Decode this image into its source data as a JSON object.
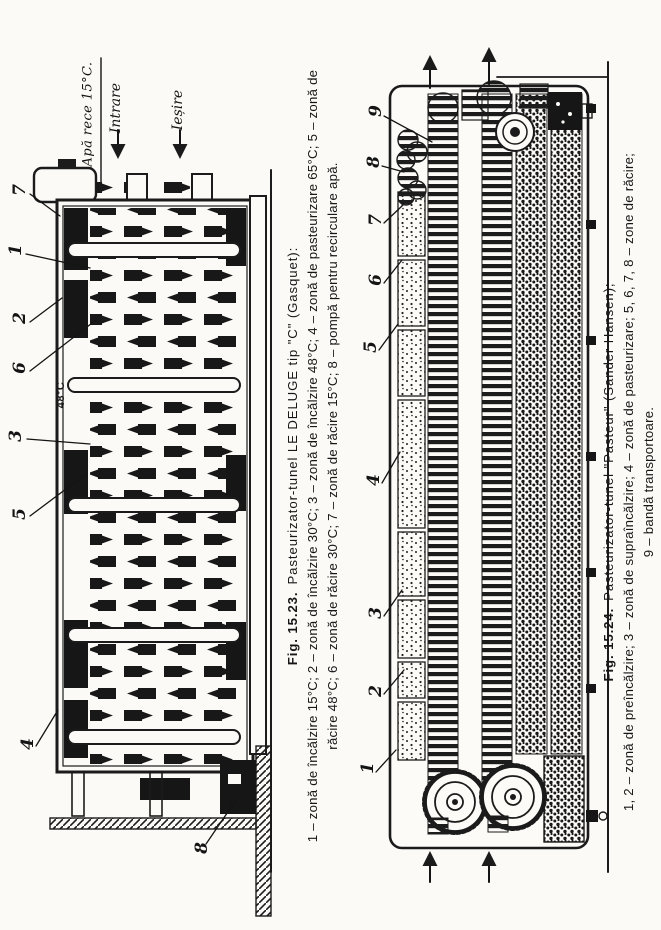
{
  "figure_15_23": {
    "caption": {
      "fig_label": "Fig. 15.23.",
      "title": "Pasteurizator-tunel LE DELUGE tip \"C\" (Gasquet):",
      "legend_line1": "1 – zonă de încălzire 15°C; 2 – zonă de încălzire 30°C; 3 – zonă de încălzire 48°C; 4 – zonă de pasteurizare 65°C; 5 – zonă de",
      "legend_line2": "răcire 48°C; 6 – zonă de răcire 30°C; 7 – zonă de răcire 15°C; 8 – pompă pentru recirculare apă."
    },
    "annotations": {
      "water_inlet": "Apă rece 15°C.",
      "inlet": "Intrare",
      "outlet": "Ieșire",
      "temperature": "48°C"
    },
    "callouts": [
      "7",
      "1",
      "2",
      "6",
      "3",
      "5",
      "4",
      "8"
    ]
  },
  "figure_15_24": {
    "caption": {
      "fig_label": "Fig. 15.24.",
      "title": "Pasteurizator-tunel \"Pasteur\" (Sander Hansen);",
      "legend_line1": "1, 2 – zonă de preîncălzire; 3 – zonă de supraîncălzire; 4 – zonă de pasteurizare; 5, 6, 7, 8 – zone de răcire;",
      "legend_line2": "9 – bandă transportoare."
    },
    "callouts": [
      "9",
      "8",
      "7",
      "6",
      "5",
      "4",
      "3",
      "2",
      "1"
    ]
  }
}
